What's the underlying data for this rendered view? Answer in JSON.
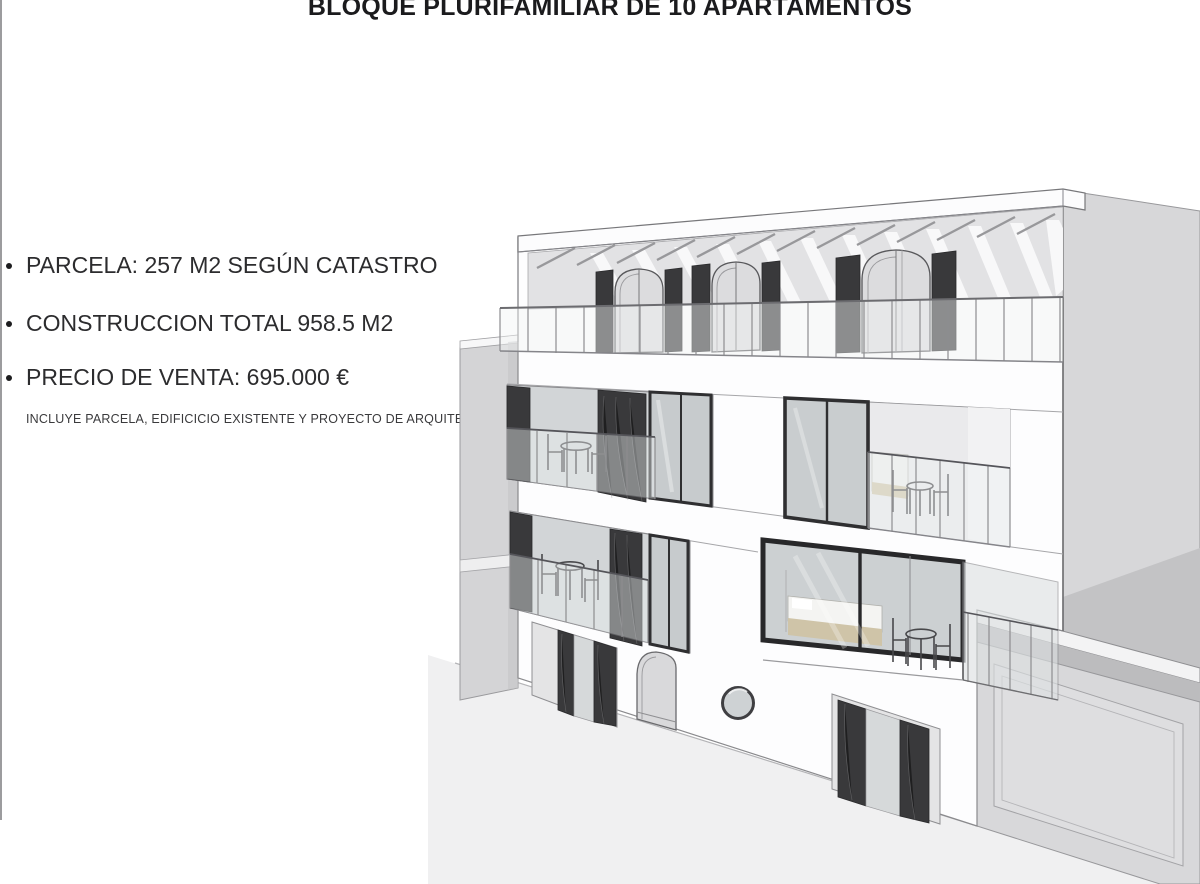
{
  "slide": {
    "title": "BLOQUE PLURIFAMILIAR DE 10 APARTAMENTOS",
    "bullets": [
      "PARCELA: 257 M2 SEGÚN CATASTRO",
      "CONSTRUCCION TOTAL 958.5 M2",
      "PRECIO DE VENTA: 695.000 €"
    ],
    "note": "INCLUYE PARCELA, EDIFICICIO EXISTENTE Y PROYECTO DE ARQUITECTURA"
  },
  "render": {
    "description": "3D architectural street-view rendering of the 10-apartment residential block with roof pergola terrace, lattice shutters, glass balconies and neighbouring buildings",
    "colors": {
      "facade_white": "#fdfdfe",
      "side_wall_gray": "#d7d7d9",
      "shadow_gray": "#c3c3c5",
      "lattice_dark": "#39393b",
      "glass": "#d3d6d8",
      "street": "#f0f0f1",
      "bed_tan": "#cfc4a8",
      "outline": "#8a8a8d"
    }
  }
}
